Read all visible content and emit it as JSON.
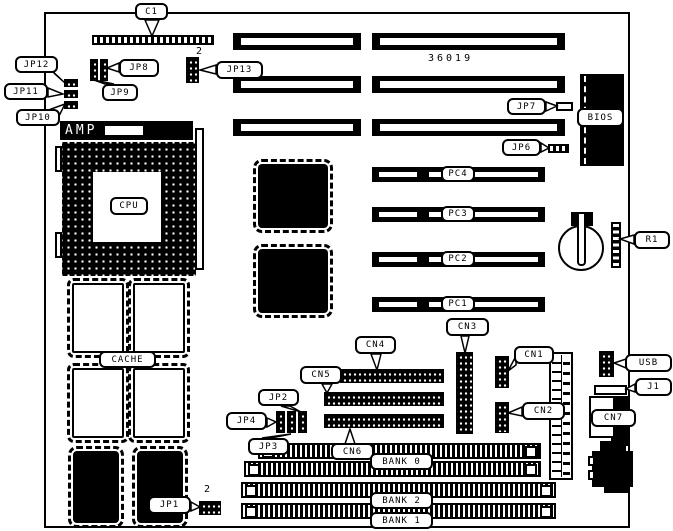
{
  "diagram": {
    "type": "motherboard-layout",
    "part_number": "36019"
  },
  "labels": {
    "c1": "C1",
    "jp12": "JP12",
    "jp11": "JP11",
    "jp10": "JP10",
    "jp8": "JP8",
    "jp9": "JP9",
    "jp13": "JP13",
    "jp13_pin2": "2",
    "jp7": "JP7",
    "jp6": "JP6",
    "bios": "BIOS",
    "amp": "AMP",
    "cpu": "CPU",
    "pc4": "PC4",
    "pc3": "PC3",
    "pc2": "PC2",
    "pc1": "PC1",
    "r1": "R1",
    "cache": "CACHE",
    "cn4": "CN4",
    "cn5": "CN5",
    "cn6": "CN6",
    "cn3": "CN3",
    "cn1": "CN1",
    "cn2": "CN2",
    "cn7": "CN7",
    "jp2": "JP2",
    "jp4": "JP4",
    "jp3": "JP3",
    "jp1": "JP1",
    "jp1_pin2": "2",
    "usb": "USB",
    "j1": "J1",
    "bank0": "BANK 0",
    "bank2": "BANK 2",
    "bank1": "BANK 1"
  },
  "colors": {
    "ink": "#000000",
    "paper": "#ffffff"
  }
}
